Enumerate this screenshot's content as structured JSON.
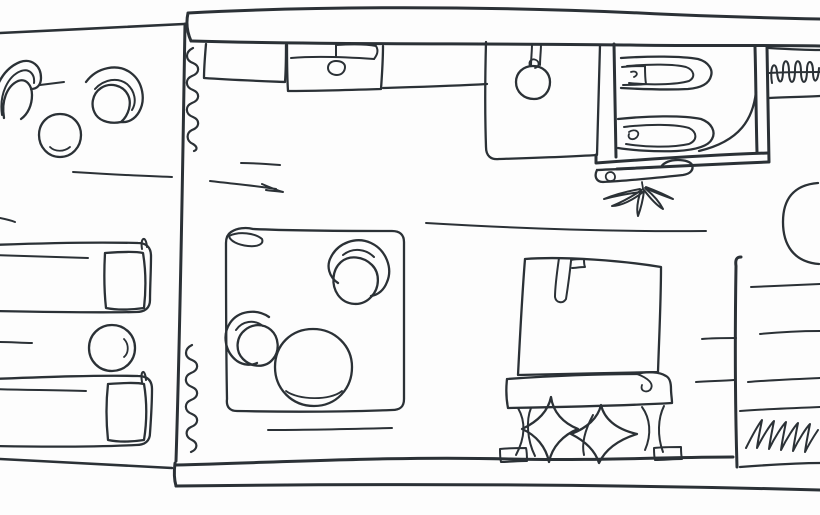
{
  "meta": {
    "title": "Hand-drawn floor plan sketch",
    "drawing_type": "single-line ink floor plan",
    "rooms": [
      {
        "name": "terrace",
        "furniture": [
          "patio-armchair",
          "patio-armchair",
          "patio-table",
          "sun-lounger",
          "sun-lounger",
          "side-table"
        ]
      },
      {
        "name": "kitchenette",
        "furniture": [
          "counter",
          "stove",
          "sink-unit",
          "pendant-lamp"
        ]
      },
      {
        "name": "bathroom",
        "furniture": [
          "toilet",
          "toilet",
          "door-swing"
        ]
      },
      {
        "name": "wardrobe",
        "furniture": [
          "hanger-rail",
          "clothes-hangers"
        ]
      },
      {
        "name": "living-area",
        "furniture": [
          "rug",
          "armchair",
          "armchair",
          "coffee-table",
          "bench",
          "plant"
        ]
      },
      {
        "name": "sleeping-area",
        "furniture": [
          "bed",
          "pillow",
          "pillow",
          "footboard-bench"
        ]
      },
      {
        "name": "storage-nook",
        "furniture": [
          "shelf-unit",
          "half-round-table",
          "radiator"
        ]
      }
    ]
  },
  "style": {
    "ink": "#2b3136",
    "paper": "#fdfdfd",
    "stroke_default": 2.3,
    "stroke_wall": 3
  },
  "drawing": {
    "width": 820,
    "height": 515,
    "elements": [
      {
        "name": "terrace-top-wall",
        "w": 2.6,
        "d": "M 0 33 C 60 30 125 27 184 24"
      },
      {
        "name": "main-top-wall-outer",
        "w": 3,
        "d": "M 188 13 C 186 22 187 32 191 41 M 188 13 C 320 6 480 6 640 13 C 700 16 770 18 820 19"
      },
      {
        "name": "main-top-wall-inner",
        "w": 3,
        "d": "M 192 41 C 330 45 480 43 630 45 C 700 46 770 45 820 46"
      },
      {
        "name": "main-left-wall",
        "w": 3,
        "d": "M 185 24 C 183 140 181 300 176 461"
      },
      {
        "name": "main-bottom-wall-inner",
        "w": 3,
        "d": "M 176 465 C 290 462 400 456 510 459 C 590 461 670 457 733 457"
      },
      {
        "name": "main-bottom-wall-outer",
        "w": 3,
        "d": "M 176 486 C 340 484 560 483 820 490"
      },
      {
        "name": "bottom-wall-left-cap",
        "w": 3,
        "d": "M 175 463 C 174 471 174 479 176 486"
      },
      {
        "name": "terrace-bottom-edge",
        "w": 2.6,
        "d": "M 0 459 C 58 462 118 465 172 468"
      },
      {
        "name": "curtain-wave-upper",
        "w": 2.2,
        "d": "M 193 48 C 185 52 185 60 193 63 C 200 66 200 73 192 76 C 185 79 185 87 193 90 C 200 93 200 100 192 103 C 185 106 185 114 193 117 C 200 120 200 127 192 130 C 186 133 186 141 193 144 C 198 147 197 150 194 151"
      },
      {
        "name": "curtain-wave-lower",
        "w": 2.2,
        "d": "M 192 345 C 184 349 184 357 192 360 C 199 363 199 370 191 373 C 184 376 184 384 192 387 C 199 390 199 397 191 400 C 184 403 184 411 192 414 C 199 417 199 424 191 427 C 185 430 185 437 192 440 C 198 443 198 449 191 452"
      },
      {
        "name": "kitchen-counter-left",
        "d": "M 206 44 C 205 56 204 67 204 78 C 232 80 260 81 285 82 C 286 69 286 57 286 45"
      },
      {
        "name": "stove-block",
        "d": "M 287 45 C 287 60 287 76 288 91 C 317 91 350 90 381 89 C 382 75 383 60 383 46"
      },
      {
        "name": "stove-handle",
        "w": 2,
        "d": "M 291 58 C 315 56 345 57 374 59"
      },
      {
        "name": "stove-flag",
        "w": 2,
        "d": "M 336 57 C 336 53 336 49 336 45 C 352 44 366 44 376 46 C 379 51 377 55 374 59"
      },
      {
        "name": "stove-knob",
        "w": 2,
        "d": "M 336 61 C 331 61 328 64 328 68 C 328 72 332 75 337 75 C 342 75 345 71 345 67 C 345 63 341 61 336 61"
      },
      {
        "name": "kitchen-counter-right",
        "d": "M 383 88 C 415 87 452 86 487 84"
      },
      {
        "name": "sink-unit",
        "d": "M 486 42 C 485 80 485 118 486 147 C 486 156 491 160 499 159 C 531 158 566 157 597 155 C 598 118 599 80 600 45"
      },
      {
        "name": "pendant-stem",
        "w": 2,
        "d": "M 532 44 C 532 51 531 59 531 66 M 541 44 C 541 51 540 58 540 65"
      },
      {
        "name": "pendant-knot",
        "w": 1.8,
        "d": "M 530 66 C 528 61 532 58 536 60 C 540 62 539 67 535 68"
      },
      {
        "name": "pendant-bowl",
        "d": "M 533 66 C 523 66 516 73 516 82 C 516 92 524 99 534 99 C 544 99 550 91 550 82 C 550 73 543 66 533 66"
      },
      {
        "name": "bath-left-wall-inner",
        "w": 3,
        "d": "M 614 44 C 615 82 615 120 616 157"
      },
      {
        "name": "bath-bottom-outer",
        "w": 3,
        "d": "M 596 155 C 596 158 596 160 596 163 C 650 159 710 155 768 153"
      },
      {
        "name": "bath-bottom-inner",
        "w": 3,
        "d": "M 617 169 C 662 167 716 164 768 162"
      },
      {
        "name": "bath-right-wall-inner",
        "w": 3,
        "d": "M 755 47 C 756 82 756 118 757 152"
      },
      {
        "name": "bath-right-wall-outer",
        "w": 3,
        "d": "M 767 47 C 768 85 768 124 769 162"
      },
      {
        "name": "bathroom-door-arc",
        "d": "M 756 92 C 753 118 741 141 699 151"
      },
      {
        "name": "toilet-1-outer",
        "d": "M 621 58 C 650 56 681 56 698 59 C 709 62 713 70 711 76 C 709 84 700 88 688 89 C 666 90 639 89 621 88"
      },
      {
        "name": "toilet-1-inner",
        "w": 2,
        "d": "M 627 66 C 650 64 674 64 686 67 C 694 70 696 77 689 81 C 676 85 648 85 629 83"
      },
      {
        "name": "toilet-1-cistern",
        "w": 2,
        "d": "M 622 67 C 630 66 638 66 645 66 C 645 72 645 78 646 84 C 638 85 630 85 623 85"
      },
      {
        "name": "toilet-1-curl",
        "w": 1.8,
        "d": "M 631 72 C 637 70 639 75 634 77"
      },
      {
        "name": "toilet-2-outer",
        "d": "M 618 119 C 646 116 682 115 701 119 C 712 123 716 132 712 139 C 708 147 694 150 677 151 C 654 152 630 150 618 148"
      },
      {
        "name": "toilet-2-inner",
        "w": 2,
        "d": "M 624 127 C 648 124 676 124 689 128 C 697 132 698 140 689 144 C 671 148 644 147 626 144"
      },
      {
        "name": "toilet-2-spiral",
        "w": 1.8,
        "d": "M 629 132 C 635 128 641 132 637 137 C 633 141 627 139 629 134"
      },
      {
        "name": "wardrobe-top",
        "d": "M 769 48 C 786 49 804 50 820 50"
      },
      {
        "name": "wardrobe-rail",
        "w": 2,
        "d": "M 769 73 C 786 72 804 72 820 72"
      },
      {
        "name": "wardrobe-hangers",
        "w": 2,
        "d": "M 772 83 C 769 64 776 60 777 72 C 778 84 783 86 783 70 C 783 58 789 58 789 72 C 789 85 795 86 795 70 C 795 58 801 58 801 72 C 801 85 807 86 807 70 C 807 59 813 59 813 72 C 813 84 818 84 819 68"
      },
      {
        "name": "wardrobe-bottom",
        "d": "M 769 98 C 786 97 804 97 820 96"
      },
      {
        "name": "half-round-table",
        "d": "M 818 183 C 792 185 783 201 783 222 C 783 244 793 262 819 264"
      },
      {
        "name": "shelf-unit-left-wall",
        "w": 3,
        "d": "M 741 257 C 737 257 735 259 736 266 C 735 330 735 400 737 467"
      },
      {
        "name": "shelf-line-1",
        "w": 2,
        "d": "M 751 287 C 774 286 798 285 820 284"
      },
      {
        "name": "shelf-line-2",
        "w": 2,
        "d": "M 702 339 C 713 338 724 338 736 338 M 760 334 C 780 332 800 331 820 331"
      },
      {
        "name": "shelf-line-3",
        "w": 2,
        "d": "M 696 382 C 709 381 722 381 734 380 M 748 382 C 772 380 797 379 820 378"
      },
      {
        "name": "shelf-band-top",
        "w": 2,
        "d": "M 740 411 C 767 409 794 408 820 407"
      },
      {
        "name": "radiator-scribble",
        "w": 2,
        "d": "M 746 448 C 752 436 758 425 762 420 C 760 430 758 440 757 448 C 763 436 770 425 774 421 C 772 431 770 441 769 449 C 775 437 782 426 786 422 C 784 432 782 442 781 450 C 787 438 794 427 798 423 C 796 433 794 443 793 451 C 799 439 806 428 810 424 C 808 434 806 444 805 452 C 809 444 814 436 818 430"
      },
      {
        "name": "shelf-unit-bottom",
        "d": "M 740 467 C 767 465 794 463 820 463"
      },
      {
        "name": "lounger-1-frame",
        "d": "M -8 245 C 45 243 96 242 138 243 C 147 243 151 248 151 256 C 151 271 150 287 150 300 C 150 308 145 312 136 312 C 94 313 44 312 -8 311"
      },
      {
        "name": "lounger-1-inner",
        "w": 2,
        "d": "M -8 255 C 24 256 56 257 88 258"
      },
      {
        "name": "lounger-1-pillow",
        "d": "M 105 253 C 118 252 134 251 143 253 C 146 271 146 290 144 308 C 130 310 116 310 106 308 C 104 290 104 271 105 253"
      },
      {
        "name": "lounger-1-pin",
        "w": 2,
        "d": "M 142 249 C 140 237 146 235 147 247"
      },
      {
        "name": "lounger-2-frame",
        "d": "M -8 379 C 45 377 96 375 138 376 C 148 376 152 381 152 389 C 152 403 151 419 150 433 C 150 441 145 445 136 445 C 94 447 44 447 -8 446"
      },
      {
        "name": "lounger-2-inner",
        "w": 2,
        "d": "M -8 389 C 23 390 54 390 86 391"
      },
      {
        "name": "lounger-2-pillow",
        "d": "M 108 384 C 121 383 136 382 144 384 C 147 402 147 421 144 440 C 131 442 118 442 108 440 C 106 421 106 402 108 384"
      },
      {
        "name": "lounger-2-pin",
        "w": 2,
        "d": "M 142 382 C 140 370 145 368 146 380"
      },
      {
        "name": "side-table-round",
        "d": "M 112 325 C 99 325 89 335 89 348 C 89 361 99 371 112 371 C 125 371 135 361 135 348 C 135 335 125 325 112 325"
      },
      {
        "name": "side-table-arc",
        "w": 1.8,
        "d": "M 124 339 C 129 344 129 353 124 357"
      },
      {
        "name": "patio-chair-1-outer",
        "d": "M -6 122 C -11 96 0 70 20 62 C 32 58 41 66 41 78 C 41 85 37 89 31 89"
      },
      {
        "name": "patio-chair-1-mid",
        "w": 2,
        "d": "M 2 115 C -1 94 8 76 21 71 C 30 68 35 75 34 83"
      },
      {
        "name": "patio-chair-1-seat",
        "d": "M 4 118 C 1 101 7 86 18 81 C 26 78 32 85 32 95 C 32 105 28 114 21 119"
      },
      {
        "name": "patio-chair-2-outer",
        "d": "M 86 82 C 97 67 118 63 131 73 C 143 82 146 100 139 112 C 135 119 128 123 121 122"
      },
      {
        "name": "patio-chair-2-mid",
        "w": 2,
        "d": "M 95 89 C 104 79 118 77 127 84 C 135 91 137 102 132 110"
      },
      {
        "name": "patio-chair-2-seat",
        "d": "M 121 122 C 112 124 101 122 96 115 C 90 106 92 94 101 88 C 110 82 123 85 128 95 C 132 103 129 115 121 122"
      },
      {
        "name": "patio-table",
        "d": "M 60 114 C 48 114 39 123 39 135 C 39 147 48 157 60 157 C 72 157 81 147 81 135 C 81 123 72 114 60 114"
      },
      {
        "name": "patio-table-arc",
        "w": 1.8,
        "d": "M 70 147 C 64 152 55 152 50 147"
      },
      {
        "name": "patio-mark",
        "w": 2,
        "d": "M 40 85 C 48 84 56 83 64 82"
      },
      {
        "name": "terrace-floor-mark",
        "w": 2,
        "d": "M 73 172 C 106 174 140 176 172 177"
      },
      {
        "name": "edge-mark-1",
        "w": 2,
        "d": "M 0 218 C 5 219 10 220 15 222"
      },
      {
        "name": "edge-mark-2",
        "w": 2,
        "d": "M 0 342 C 11 342 22 343 32 343"
      },
      {
        "name": "floor-mark-1",
        "w": 2,
        "d": "M 241 163 C 254 163 267 164 280 165"
      },
      {
        "name": "floor-mark-2",
        "w": 2,
        "d": "M 210 181 C 235 184 258 186 276 189 M 262 184 C 269 187 276 190 283 192 C 277 191 271 191 266 190"
      },
      {
        "name": "floor-mark-3",
        "w": 2,
        "d": "M 426 223 C 510 228 610 232 706 231"
      },
      {
        "name": "rug-outline",
        "d": "M 231 232 C 237 228 246 227 253 229 C 300 231 350 231 392 231 C 400 231 404 235 404 242 C 404 295 404 350 404 399 C 404 407 400 410 392 410 C 340 412 286 412 237 411 C 230 411 226 407 227 399 C 226 347 226 295 226 243 C 226 237 228 234 231 232"
      },
      {
        "name": "rug-fold",
        "w": 2,
        "d": "M 229 236 C 239 231 255 233 262 239 C 264 244 258 247 248 246 C 238 245 230 241 229 236"
      },
      {
        "name": "rug-chair-1-outer",
        "d": "M 338 283 C 329 277 326 266 331 257 C 338 243 356 236 371 243 C 386 250 393 268 387 282 C 384 290 378 295 371 296"
      },
      {
        "name": "rug-chair-1-mid",
        "w": 2,
        "d": "M 343 255 C 353 247 366 249 374 257"
      },
      {
        "name": "rug-chair-1-seat",
        "d": "M 341 262 C 332 270 331 285 338 295 C 346 306 362 307 371 297 C 380 288 380 273 372 265 C 363 256 349 255 341 262"
      },
      {
        "name": "rug-chair-2-outer",
        "d": "M 269 317 C 256 308 238 311 230 323 C 222 335 225 352 237 361 C 243 365 251 366 257 363"
      },
      {
        "name": "rug-chair-2-mid",
        "w": 2,
        "d": "M 263 326 C 254 319 242 321 236 330"
      },
      {
        "name": "rug-chair-2-seat",
        "d": "M 245 330 C 236 337 235 351 243 359 C 252 368 266 368 273 359 C 280 351 279 337 271 330 C 263 323 252 324 245 330"
      },
      {
        "name": "coffee-table",
        "d": "M 313 329 C 291 329 275 345 275 367 C 275 389 292 406 314 406 C 336 406 352 389 352 367 C 352 346 335 329 313 329"
      },
      {
        "name": "coffee-table-arc",
        "w": 1.8,
        "d": "M 286 391 C 298 400 330 401 342 391"
      },
      {
        "name": "rug-mark",
        "w": 2,
        "d": "M 268 430 C 310 430 352 429 392 428"
      },
      {
        "name": "bed-duvet",
        "d": "M 525 259 C 565 256 625 261 661 267 C 661 302 659 340 658 372 C 612 373 563 374 518 375 C 520 336 522 296 525 259"
      },
      {
        "name": "bed-pillow-tab",
        "w": 2,
        "d": "M 559 258 C 557 272 555 288 555 297 C 556 303 563 304 566 299 C 568 286 570 271 571 261"
      },
      {
        "name": "bed-tab-box",
        "w": 2,
        "d": "M 571 260 C 575 259 580 259 584 259 C 584 262 584 265 585 267 C 580 267 576 268 572 268"
      },
      {
        "name": "bed-footboard",
        "d": "M 507 379 C 550 376 598 374 637 374 C 647 371 660 372 666 376 C 670 378 671 383 671 389 C 671 394 672 399 672 403 C 620 406 562 407 508 408 C 506 398 506 388 507 379"
      },
      {
        "name": "footboard-curl",
        "w": 1.8,
        "d": "M 637 374 C 648 378 655 384 650 390 C 646 393 640 391 642 385"
      },
      {
        "name": "bed-leg-left",
        "w": 2,
        "d": "M 518 408 C 526 422 525 438 516 455 M 531 408 C 526 420 527 440 535 456"
      },
      {
        "name": "bed-foot-left",
        "w": 2,
        "d": "M 500 449 C 509 448 518 448 526 448 C 527 452 527 457 527 461 C 518 461 509 462 501 462 C 500 458 500 453 500 449"
      },
      {
        "name": "bed-leg-right",
        "w": 2,
        "d": "M 642 407 C 650 418 652 434 645 450 M 664 406 C 658 418 657 436 663 452"
      },
      {
        "name": "bed-foot-right",
        "w": 2,
        "d": "M 654 448 C 663 447 672 447 681 447 C 681 451 681 455 682 459 C 673 459 664 460 655 460 C 654 456 654 452 654 448"
      },
      {
        "name": "pillow-star-1",
        "d": "M 551 397 C 553 412 563 423 578 429 C 563 435 552 447 549 462 C 546 447 536 435 522 429 C 537 422 548 412 551 397"
      },
      {
        "name": "pillow-star-2",
        "d": "M 601 405 C 604 418 615 429 637 434 C 618 440 605 450 599 463 C 595 450 585 441 571 434 C 587 428 598 418 601 405"
      },
      {
        "name": "pillow-2-fold",
        "w": 2,
        "d": "M 593 415 C 586 428 581 442 584 455"
      },
      {
        "name": "bench",
        "d": "M 597 170 C 620 169 645 168 661 167 C 664 162 671 160 678 160 C 685 160 691 162 692 165 C 694 170 690 174 683 175 C 655 178 626 181 603 182 C 596 182 594 176 597 170"
      },
      {
        "name": "bench-knob",
        "w": 1.8,
        "d": "M 611 172 C 607 172 605 175 606 178 C 607 181 611 182 614 180 C 616 177 615 173 611 172"
      },
      {
        "name": "plant-stem",
        "w": 1.8,
        "d": "M 642 182 C 642 184 643 187 643 189"
      },
      {
        "name": "plant-leaf-1",
        "w": 2,
        "d": "M 643 189 C 633 196 622 202 612 206 C 621 206 633 200 643 192"
      },
      {
        "name": "plant-leaf-2",
        "w": 2,
        "d": "M 641 190 C 638 199 636 208 638 216 C 641 208 643 199 644 191"
      },
      {
        "name": "plant-leaf-3",
        "w": 2,
        "d": "M 644 190 C 650 198 656 205 663 209 C 659 201 652 194 646 189"
      },
      {
        "name": "plant-leaf-4",
        "w": 2,
        "d": "M 640 189 C 629 191 616 194 604 199 C 616 196 630 193 642 192"
      },
      {
        "name": "plant-leaf-5",
        "w": 2,
        "d": "M 645 188 C 654 192 664 196 673 199 C 664 194 654 190 646 187"
      }
    ]
  }
}
